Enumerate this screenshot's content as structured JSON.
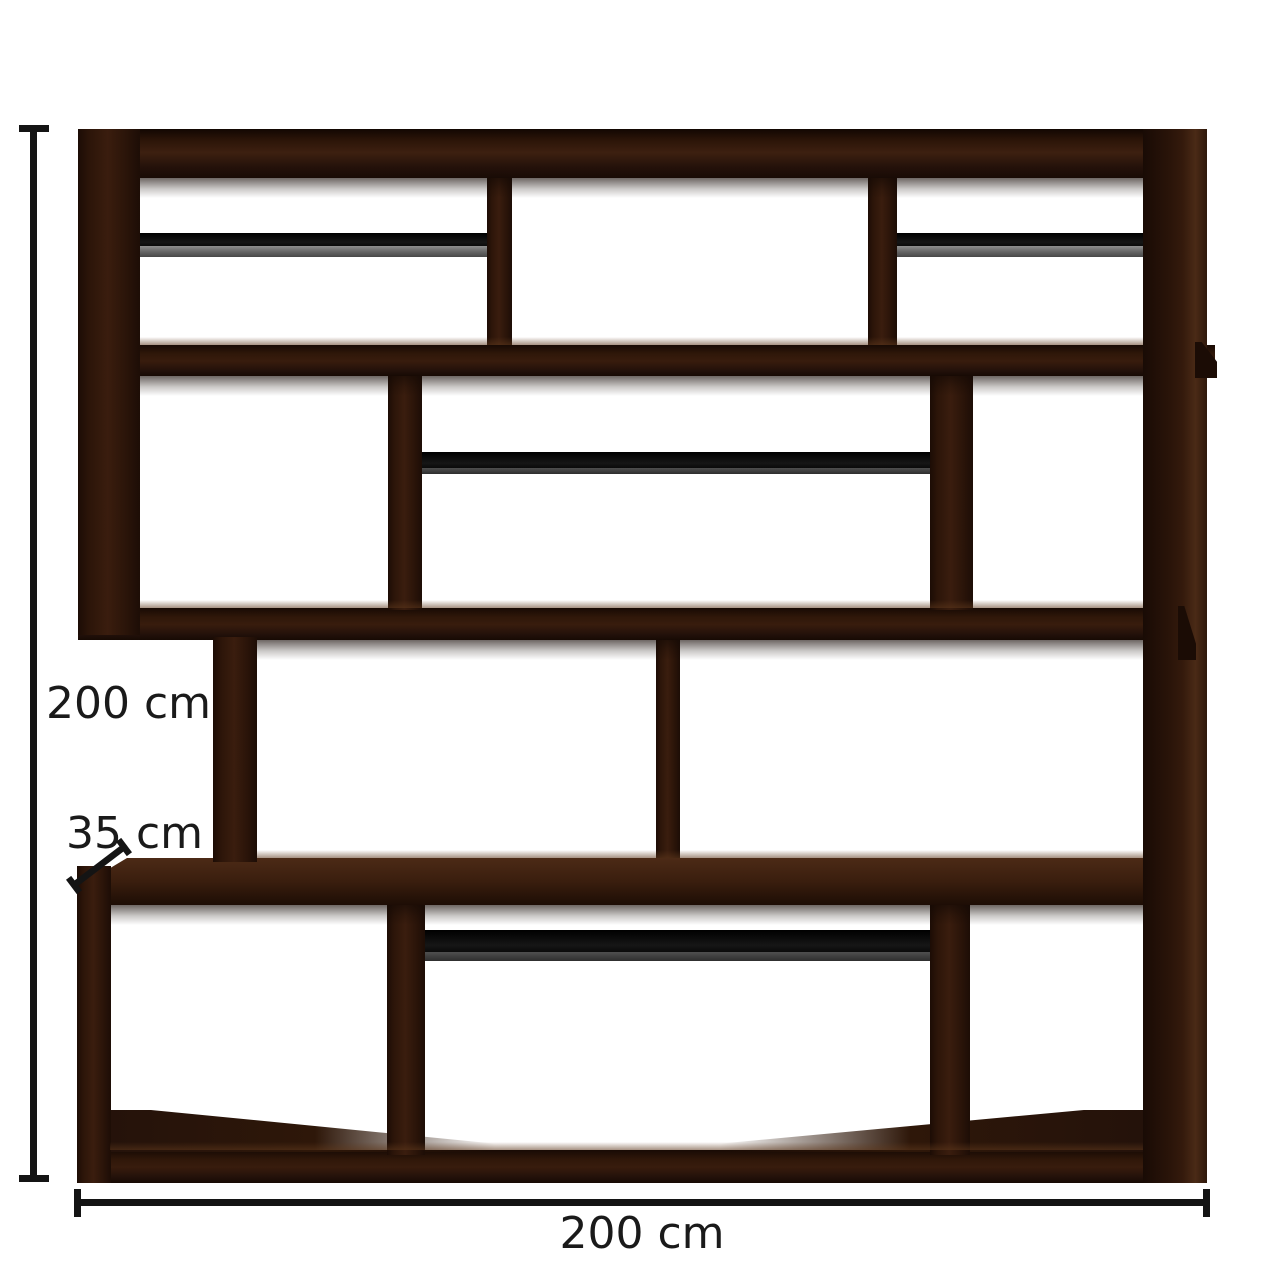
{
  "page": {
    "background": "#ffffff",
    "description": "Product dimension diagram of a dark walnut zigzag open bookcase with four staggered tiers, eleven open compartments and four black hanging rails"
  },
  "product": {
    "tiers": 4,
    "open_compartments": 11,
    "hang_rails": 4
  },
  "dimensions": {
    "height": {
      "label": "200 cm"
    },
    "depth": {
      "label": "35 cm"
    },
    "width": {
      "label": "200 cm"
    }
  },
  "colors": {
    "wood_dark": "#2a1409",
    "wood_mid": "#3a1d0e",
    "wood_light_edge": "#4a2a16",
    "rail_black": "#0c0c0c",
    "rail_gray": "#6a6a6a",
    "dimension_line": "#141414",
    "label_text": "#1a1a1a",
    "background": "#ffffff"
  }
}
